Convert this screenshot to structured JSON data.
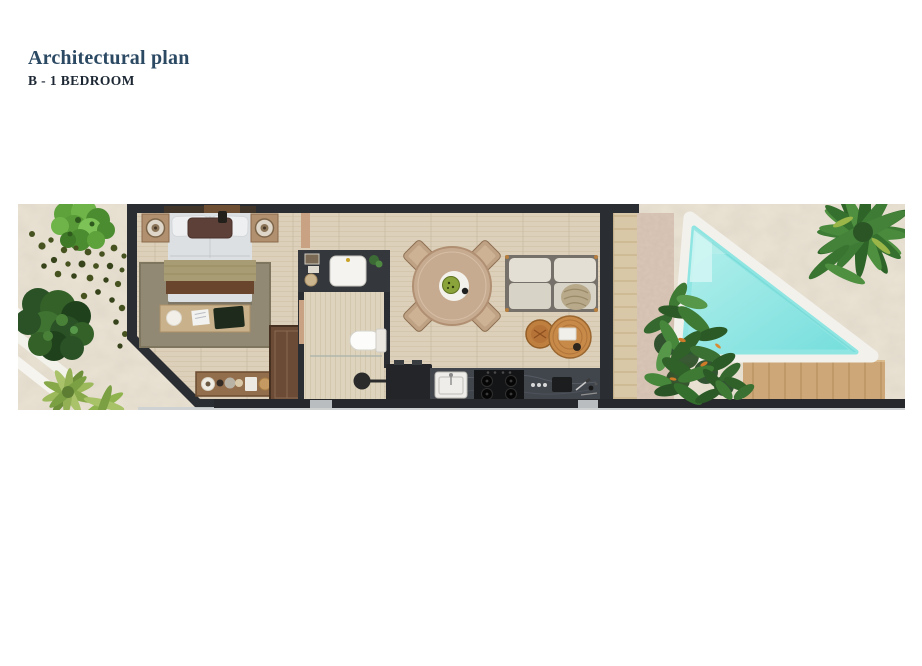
{
  "header": {
    "title": "Architectural plan",
    "subtitle": "B - 1 BEDROOM"
  },
  "colors": {
    "page_background": "#ffffff",
    "title": "#2b4963",
    "subtitle": "#1c2733",
    "sand": "#ebe4d5",
    "floor": "#dcd0ba",
    "wall": "#2a2d31",
    "pool_water": "#7fe1df",
    "pool_rim": "#f3f1ec",
    "deck_wood": "#cda778",
    "stone_path": "#d9c7b8",
    "foliage_dark": "#2c5a27",
    "foliage_light": "#65a244",
    "rattan": "#c78a49",
    "rug": "#918974"
  },
  "plan": {
    "description": "Top-down rendered floor plan of a one-bedroom unit with garden, terrace and triangular plunge pool",
    "rooms": [
      "bedroom",
      "bathroom",
      "living-dining",
      "kitchen",
      "terrace",
      "pool-area"
    ],
    "furniture": [
      "double-bed",
      "nightstand-lamps",
      "bedroom-bench",
      "area-rug",
      "wardrobe",
      "console-shelf",
      "vanity-sink",
      "toilet",
      "shower-drain",
      "round-dining-table",
      "dining-chairs",
      "sofa",
      "rattan-coffee-tables",
      "kitchen-counter",
      "kitchen-sink",
      "gas-stove",
      "kitchen-island",
      "sun-deck",
      "plunge-pool",
      "palm-tree",
      "garden-shrubs"
    ]
  }
}
